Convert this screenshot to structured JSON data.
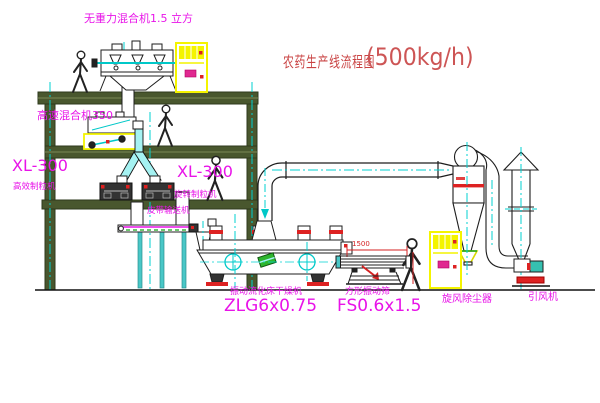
{
  "title": {
    "zh": "农药生产线流程图",
    "capacity": "(500kg/h)"
  },
  "equipment_labels": {
    "gravity_mixer": "无重力混合机1.5 立方",
    "high_speed_mixer": "高速混合机350",
    "granulator_left_model": "XL-300",
    "granulator_left_name": "高效制粒机",
    "granulator_mid_model": "XL-300",
    "granulator_mid_name": "旋转制粒机",
    "belt_conveyor": "皮带输送机",
    "dryer_name": "振动流化床干燥机",
    "dryer_model": "ZLG6x0.75",
    "screen_name": "方形振动筛",
    "screen_model": "FS0.6x1.5",
    "cyclone_name": "旋风除尘器",
    "fan_name": "引风机"
  },
  "dimensions": {
    "screen_length": "1500"
  },
  "colors": {
    "label_magenta": "#e813e8",
    "title_red": "#c94343",
    "structure_olive": "#49572e",
    "centerline_cyan": "#00d2d2",
    "cabinet_yellow": "#f4f400",
    "accent_red": "#dd2222",
    "chute_cyan": "#a5f2f2",
    "conveyor_green": "#18a018"
  }
}
